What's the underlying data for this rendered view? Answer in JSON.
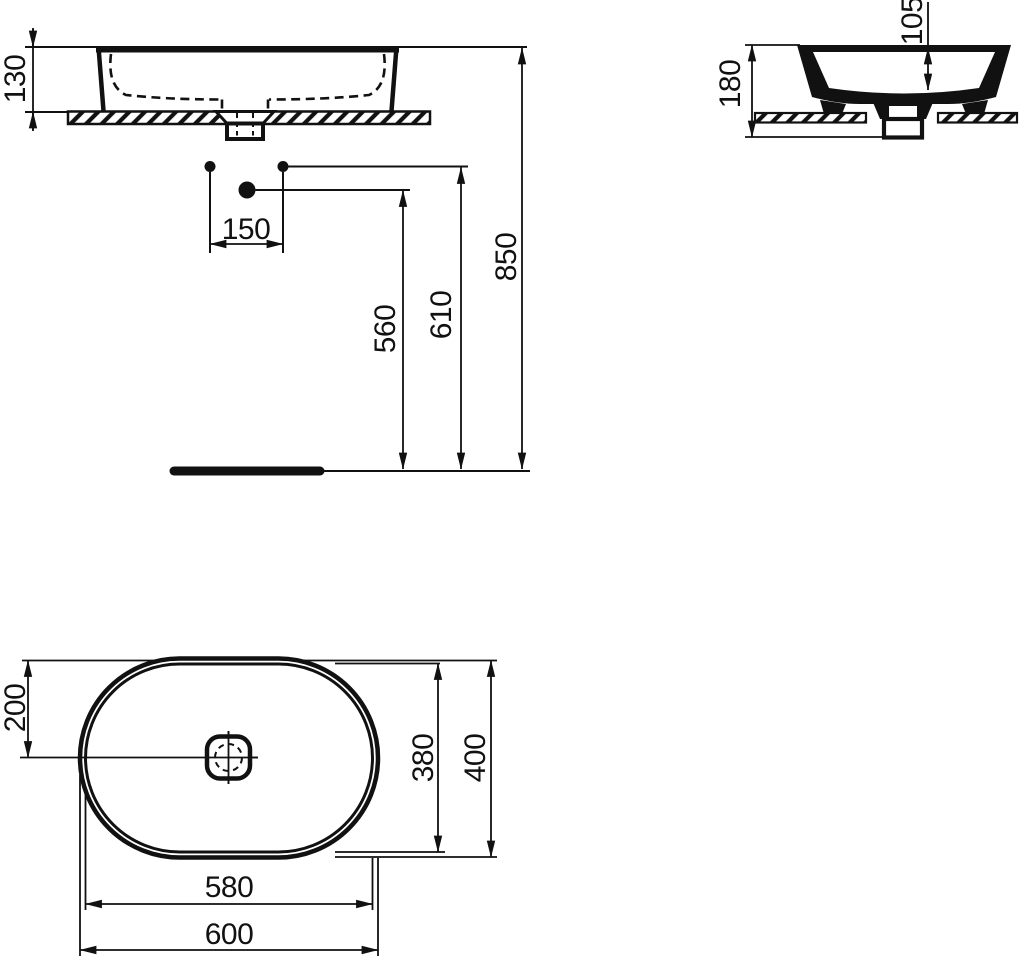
{
  "colors": {
    "ink": "#111111",
    "paper": "#ffffff"
  },
  "front_view": {
    "basin_height_above_counter": "130",
    "hole_spacing": "150",
    "waste_connection_height": "560",
    "supply_connection_height": "610",
    "rim_height_from_floor": "850"
  },
  "side_view": {
    "overall_height": "180",
    "bowl_inner_depth": "105"
  },
  "plan_view": {
    "rim_to_centre": "200",
    "inner_width": "380",
    "overall_width": "400",
    "inner_length": "580",
    "overall_length": "600"
  }
}
